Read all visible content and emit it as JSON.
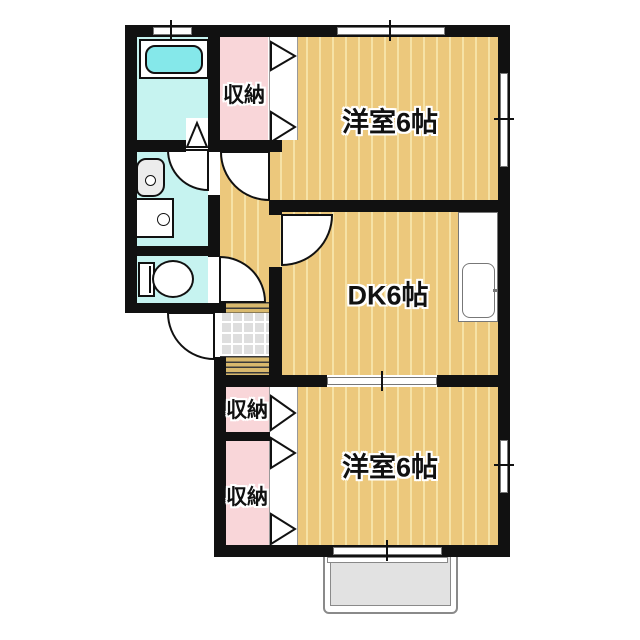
{
  "meta": {
    "type": "japanese-apartment-floor-plan"
  },
  "labels": {
    "closet": "収納",
    "western_room": "洋室6帖",
    "dining_kitchen": "DK6帖"
  },
  "rooms": [
    {
      "name": "closet-top",
      "label": "収納"
    },
    {
      "name": "western-room-top",
      "label": "洋室6帖"
    },
    {
      "name": "dining-kitchen",
      "label": "DK6帖"
    },
    {
      "name": "closet-middle",
      "label": "収納"
    },
    {
      "name": "closet-bottom",
      "label": "収納"
    },
    {
      "name": "western-room-bottom",
      "label": "洋室6帖"
    },
    {
      "name": "bathroom",
      "label": ""
    },
    {
      "name": "washroom",
      "label": ""
    },
    {
      "name": "toilet-room",
      "label": ""
    },
    {
      "name": "genkan-entrance",
      "label": ""
    },
    {
      "name": "staircase",
      "label": ""
    }
  ],
  "fixtures": [
    "bathtub",
    "vanity-sink",
    "washing-machine-pan",
    "toilet",
    "kitchen-counter",
    "kitchen-sink",
    "entrance-door",
    "genkan-tile",
    "staircase-steps",
    "entrance-porch",
    "window",
    "sliding-door",
    "folding-door"
  ],
  "colors": {
    "wall": "#111111",
    "wood_floor": "#ecc87c",
    "wood_stripe": "#f6e2a6",
    "closet_pink": "#f9d6d9",
    "wet_area_cyan": "#c6f3f0",
    "bathtub_cyan": "#85e8ea",
    "tile_gray": "#dedede",
    "stair_tan": "#d9b96d",
    "porch_gray": "#e2e2e2"
  }
}
